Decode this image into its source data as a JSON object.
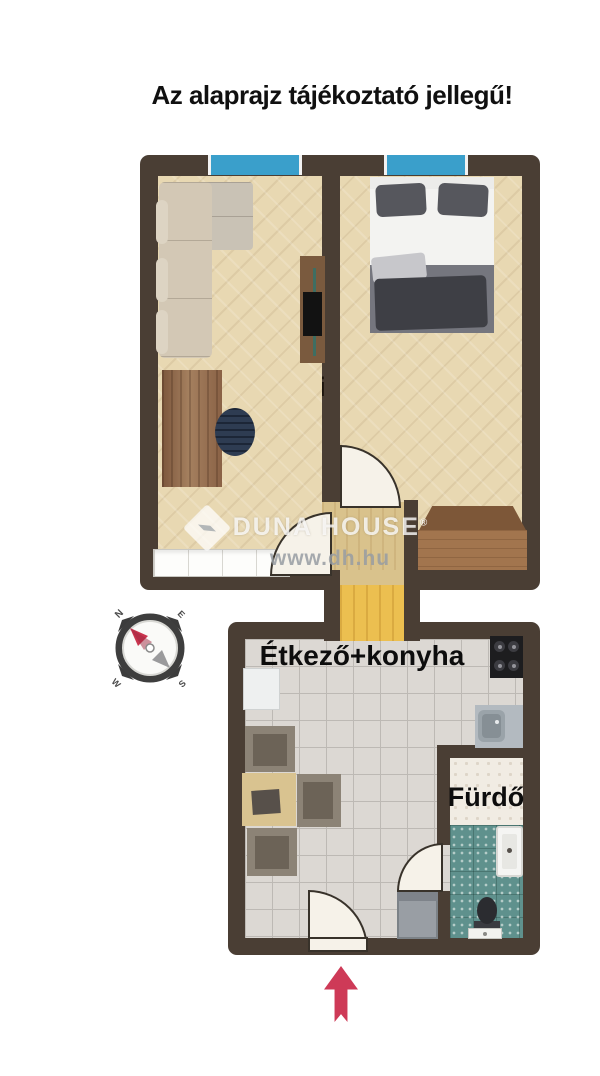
{
  "title": "Az alaprajz tájékoztató jellegű!",
  "plan": {
    "rooms": [
      {
        "id": "living",
        "label": "Nappali"
      },
      {
        "id": "bedroom",
        "label": "Hálószoba"
      },
      {
        "id": "kitchen",
        "label": "Étkező+konyha"
      },
      {
        "id": "bathroom",
        "label": "Fürdő"
      }
    ]
  },
  "watermark": {
    "brand": "DUNA HOUSE",
    "registered": "®",
    "url": "www.dh.hu"
  },
  "compass": {
    "n": "N",
    "e": "E",
    "s": "S",
    "w": "W"
  },
  "icons": {
    "compass": "compass-rose-icon",
    "entry_arrow": "entrance-arrow-icon",
    "windows": "window-icon",
    "watermark_logo": "duna-house-diamond-icon"
  },
  "colors": {
    "wall": "#4a3e34",
    "wood_floor": "#e8d8b2",
    "vestibule_floor": "#d9c28c",
    "hall_floor": "#ecbf50",
    "kitchen_tile": "#dcd8d3",
    "bathroom_tile": "#5f918d",
    "window_blue": "#3a9fcb",
    "entry_arrow": "#ce3a57",
    "compass_needle": "#c9344e",
    "title_text": "#101010"
  }
}
